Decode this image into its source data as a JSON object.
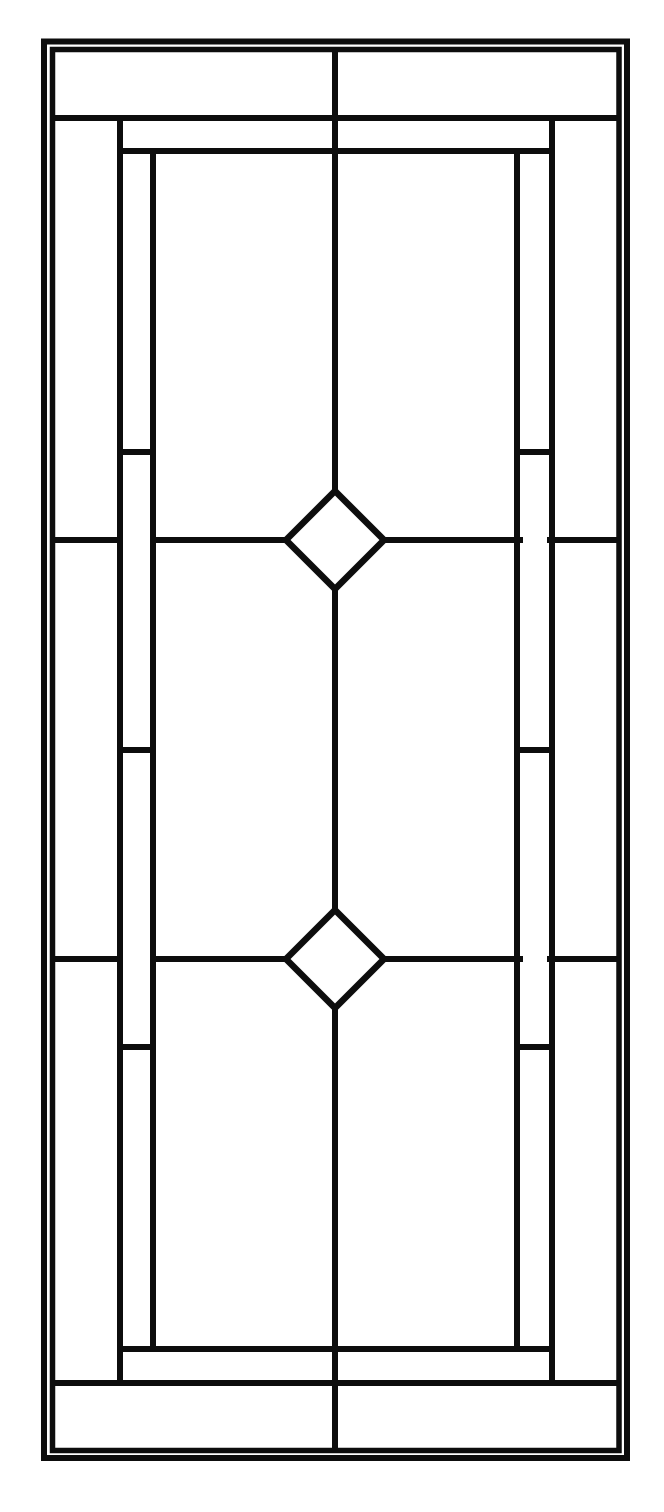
{
  "meta": {
    "title": "leaded-glass-panel-line-pattern",
    "canvas": {
      "width": 664,
      "height": 1512,
      "background": "#ffffff"
    },
    "line_color": "#0d0d0d",
    "glass_fill": "#ffffff"
  },
  "pattern": {
    "border_rects": [
      {
        "name": "outer-border",
        "x1": 44,
        "y1": 41.5,
        "x2": 627,
        "y2": 1458,
        "stroke_width": 6
      },
      {
        "name": "inner-border",
        "x1": 52.5,
        "y1": 49.5,
        "x2": 619,
        "y2": 1450.5,
        "stroke_width": 5.5
      }
    ],
    "lead_lines": [
      {
        "name": "top-band-line",
        "x1": 53,
        "y1": 118,
        "x2": 619,
        "y2": 118,
        "stroke_width": 6
      },
      {
        "name": "top-inner-line",
        "x1": 117,
        "y1": 151,
        "x2": 555,
        "y2": 151,
        "stroke_width": 6
      },
      {
        "name": "bottom-band-line",
        "x1": 53,
        "y1": 1383,
        "x2": 619,
        "y2": 1383,
        "stroke_width": 6
      },
      {
        "name": "bottom-inner-line",
        "x1": 117,
        "y1": 1349,
        "x2": 555,
        "y2": 1349,
        "stroke_width": 6
      },
      {
        "name": "left-outer-stile",
        "x1": 120,
        "y1": 115,
        "x2": 120,
        "y2": 1386,
        "stroke_width": 6
      },
      {
        "name": "right-outer-stile",
        "x1": 552,
        "y1": 115,
        "x2": 552,
        "y2": 1386,
        "stroke_width": 6
      },
      {
        "name": "left-inner-stile",
        "x1": 153,
        "y1": 148,
        "x2": 153,
        "y2": 1352,
        "stroke_width": 6
      },
      {
        "name": "right-inner-stile",
        "x1": 517,
        "y1": 148,
        "x2": 517,
        "y2": 1352,
        "stroke_width": 6
      },
      {
        "name": "center-line-upper",
        "x1": 335,
        "y1": 49.5,
        "x2": 335,
        "y2": 494,
        "stroke_width": 6
      },
      {
        "name": "center-line-middle",
        "x1": 335,
        "y1": 586,
        "x2": 335,
        "y2": 913,
        "stroke_width": 6
      },
      {
        "name": "center-line-lower",
        "x1": 335,
        "y1": 1005,
        "x2": 335,
        "y2": 1450.5,
        "stroke_width": 6
      },
      {
        "name": "upper-rail-left-outer",
        "x1": 53,
        "y1": 540,
        "x2": 123,
        "y2": 540,
        "stroke_width": 6
      },
      {
        "name": "upper-rail-left-inner",
        "x1": 150,
        "y1": 540,
        "x2": 290,
        "y2": 540,
        "stroke_width": 6
      },
      {
        "name": "upper-rail-right-inner",
        "x1": 380,
        "y1": 540,
        "x2": 523,
        "y2": 540,
        "stroke_width": 6
      },
      {
        "name": "upper-rail-right-outer",
        "x1": 547,
        "y1": 540,
        "x2": 619,
        "y2": 540,
        "stroke_width": 6
      },
      {
        "name": "lower-rail-left-outer",
        "x1": 53,
        "y1": 959,
        "x2": 123,
        "y2": 959,
        "stroke_width": 6
      },
      {
        "name": "lower-rail-left-inner",
        "x1": 150,
        "y1": 959,
        "x2": 290,
        "y2": 959,
        "stroke_width": 6
      },
      {
        "name": "lower-rail-right-inner",
        "x1": 380,
        "y1": 959,
        "x2": 523,
        "y2": 959,
        "stroke_width": 6
      },
      {
        "name": "lower-rail-right-outer",
        "x1": 547,
        "y1": 959,
        "x2": 619,
        "y2": 959,
        "stroke_width": 6
      },
      {
        "name": "left-rung-top",
        "x1": 117,
        "y1": 452,
        "x2": 156,
        "y2": 452,
        "stroke_width": 6
      },
      {
        "name": "left-rung-middle",
        "x1": 117,
        "y1": 750,
        "x2": 156,
        "y2": 750,
        "stroke_width": 6
      },
      {
        "name": "left-rung-bottom",
        "x1": 117,
        "y1": 1047,
        "x2": 156,
        "y2": 1047,
        "stroke_width": 6
      },
      {
        "name": "right-rung-top",
        "x1": 514,
        "y1": 452,
        "x2": 553,
        "y2": 452,
        "stroke_width": 6
      },
      {
        "name": "right-rung-middle",
        "x1": 514,
        "y1": 750,
        "x2": 553,
        "y2": 750,
        "stroke_width": 6
      },
      {
        "name": "right-rung-bottom",
        "x1": 514,
        "y1": 1047,
        "x2": 553,
        "y2": 1047,
        "stroke_width": 6
      }
    ],
    "diamonds": [
      {
        "name": "upper-diamond",
        "cx": 335,
        "cy": 540,
        "r": 49,
        "stroke_width": 6.5
      },
      {
        "name": "lower-diamond",
        "cx": 335,
        "cy": 959,
        "r": 49,
        "stroke_width": 6.5
      }
    ]
  }
}
